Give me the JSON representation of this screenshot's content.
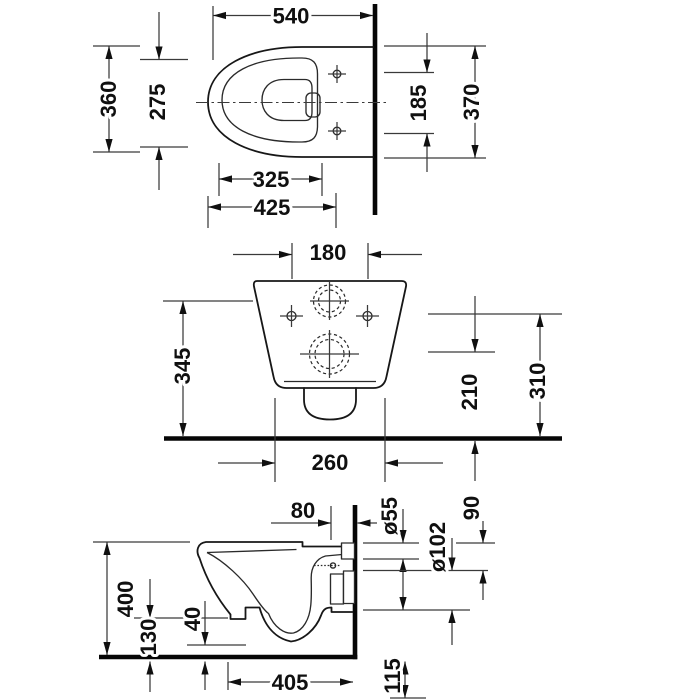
{
  "drawing": {
    "type": "technical-dimension-drawing",
    "subject": "wall-hung-toilet",
    "colors": {
      "background": "#ffffff",
      "line": "#171717",
      "text": "#101010"
    },
    "views": {
      "top": {
        "d540": "540",
        "d360": "360",
        "d275": "275",
        "d325": "325",
        "d425": "425",
        "d185": "185",
        "d370": "370"
      },
      "front": {
        "d180": "180",
        "d345": "345",
        "d210": "210",
        "d310": "310",
        "d260": "260"
      },
      "side": {
        "d80": "80",
        "d55": "ø55",
        "d102": "ø102",
        "d90": "90",
        "d400": "400",
        "d130": "130",
        "d40": "40",
        "d405": "405",
        "d115": "115"
      }
    }
  }
}
